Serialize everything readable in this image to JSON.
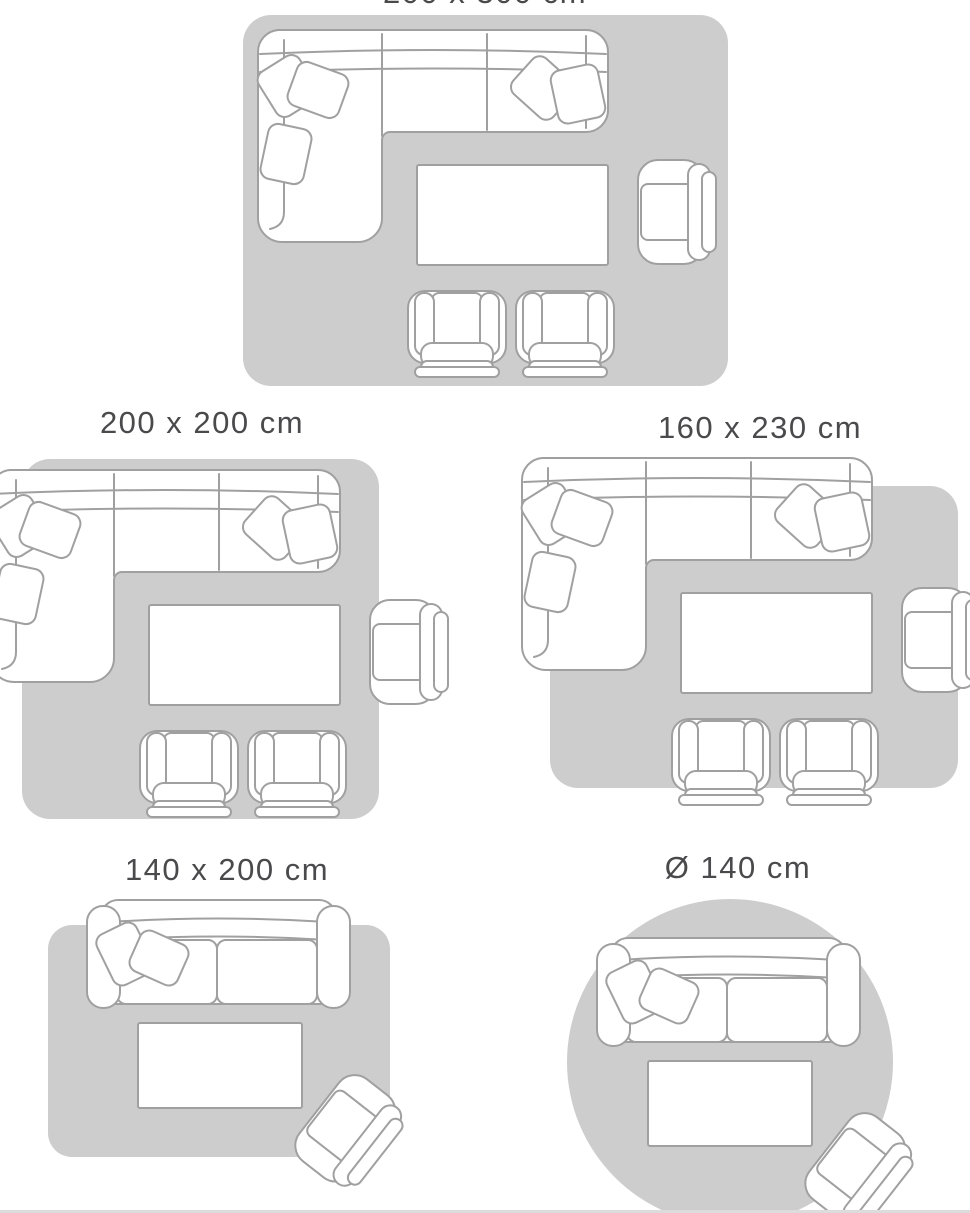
{
  "page": {
    "background": "#ffffff",
    "divider_color": "#dcdcdc"
  },
  "colors": {
    "rug_fill": "#cdcdcd",
    "furniture_fill": "#ffffff",
    "furniture_outline": "#a0a0a0",
    "label_text": "#4a4a4c"
  },
  "diagrams": [
    {
      "id": "rug-200x300",
      "label": "200 x 300 cm",
      "rug_shape": "rectangle",
      "furniture": [
        "corner-sofa",
        "coffee-table",
        "armchair",
        "chair",
        "chair"
      ]
    },
    {
      "id": "rug-200x200",
      "label": "200 x 200 cm",
      "rug_shape": "rectangle",
      "furniture": [
        "corner-sofa",
        "coffee-table",
        "armchair",
        "chair",
        "chair"
      ]
    },
    {
      "id": "rug-160x230",
      "label": "160 x 230 cm",
      "rug_shape": "rectangle",
      "furniture": [
        "corner-sofa",
        "coffee-table",
        "armchair",
        "chair",
        "chair"
      ]
    },
    {
      "id": "rug-140x200",
      "label": "140 x 200 cm",
      "rug_shape": "rectangle",
      "furniture": [
        "sofa",
        "coffee-table",
        "armchair"
      ]
    },
    {
      "id": "rug-round-140",
      "label": "Ø 140 cm",
      "rug_shape": "circle",
      "furniture": [
        "sofa",
        "coffee-table",
        "armchair"
      ]
    }
  ]
}
